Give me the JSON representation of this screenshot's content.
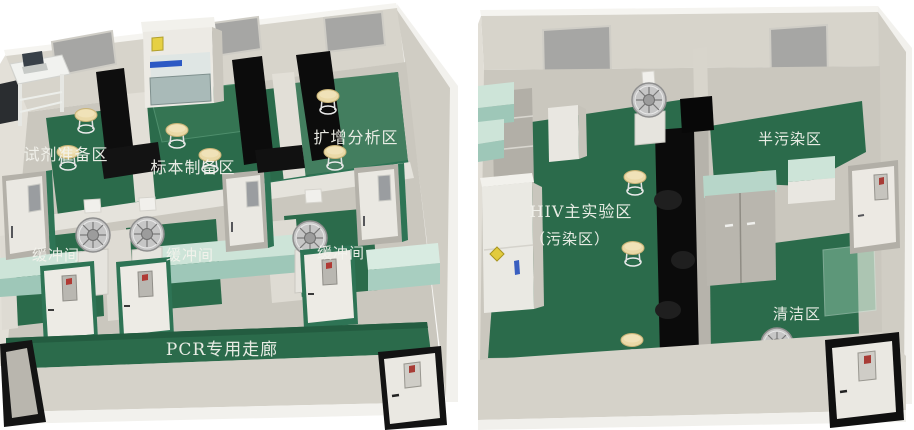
{
  "pcr_lab": {
    "zones": {
      "reagent_prep": "试剂准备区",
      "specimen_prep": "标本制备区",
      "amplification": "扩增分析区",
      "buffer_1": "缓冲间",
      "buffer_2": "缓冲间",
      "buffer_3": "缓冲间",
      "corridor": "PCR专用走廊"
    }
  },
  "hiv_lab": {
    "zones": {
      "main": "HIV主实验区",
      "main_sub": "（污染区）",
      "semi_contaminated": "半污染区",
      "clean": "清洁区"
    }
  },
  "colors": {
    "floor_green": "#2b6b4b",
    "floor_green_light": "#437e5f",
    "wall_light": "#d7d4cb",
    "wall_white_edge": "#f4f3ef",
    "window_gray": "#a6a6a4",
    "bench_black": "#0d0d0d",
    "counter_teal_top": "#cde4d8",
    "counter_teal_front": "#9ec7b8",
    "door_frame_green": "#2e7455",
    "door_frame_black": "#131313",
    "stool_tan": "#ead9a7",
    "label_text": "#f3f3ed",
    "biohazard_yellow": "#e2cb3e",
    "brand_blue": "#2c59c4"
  }
}
